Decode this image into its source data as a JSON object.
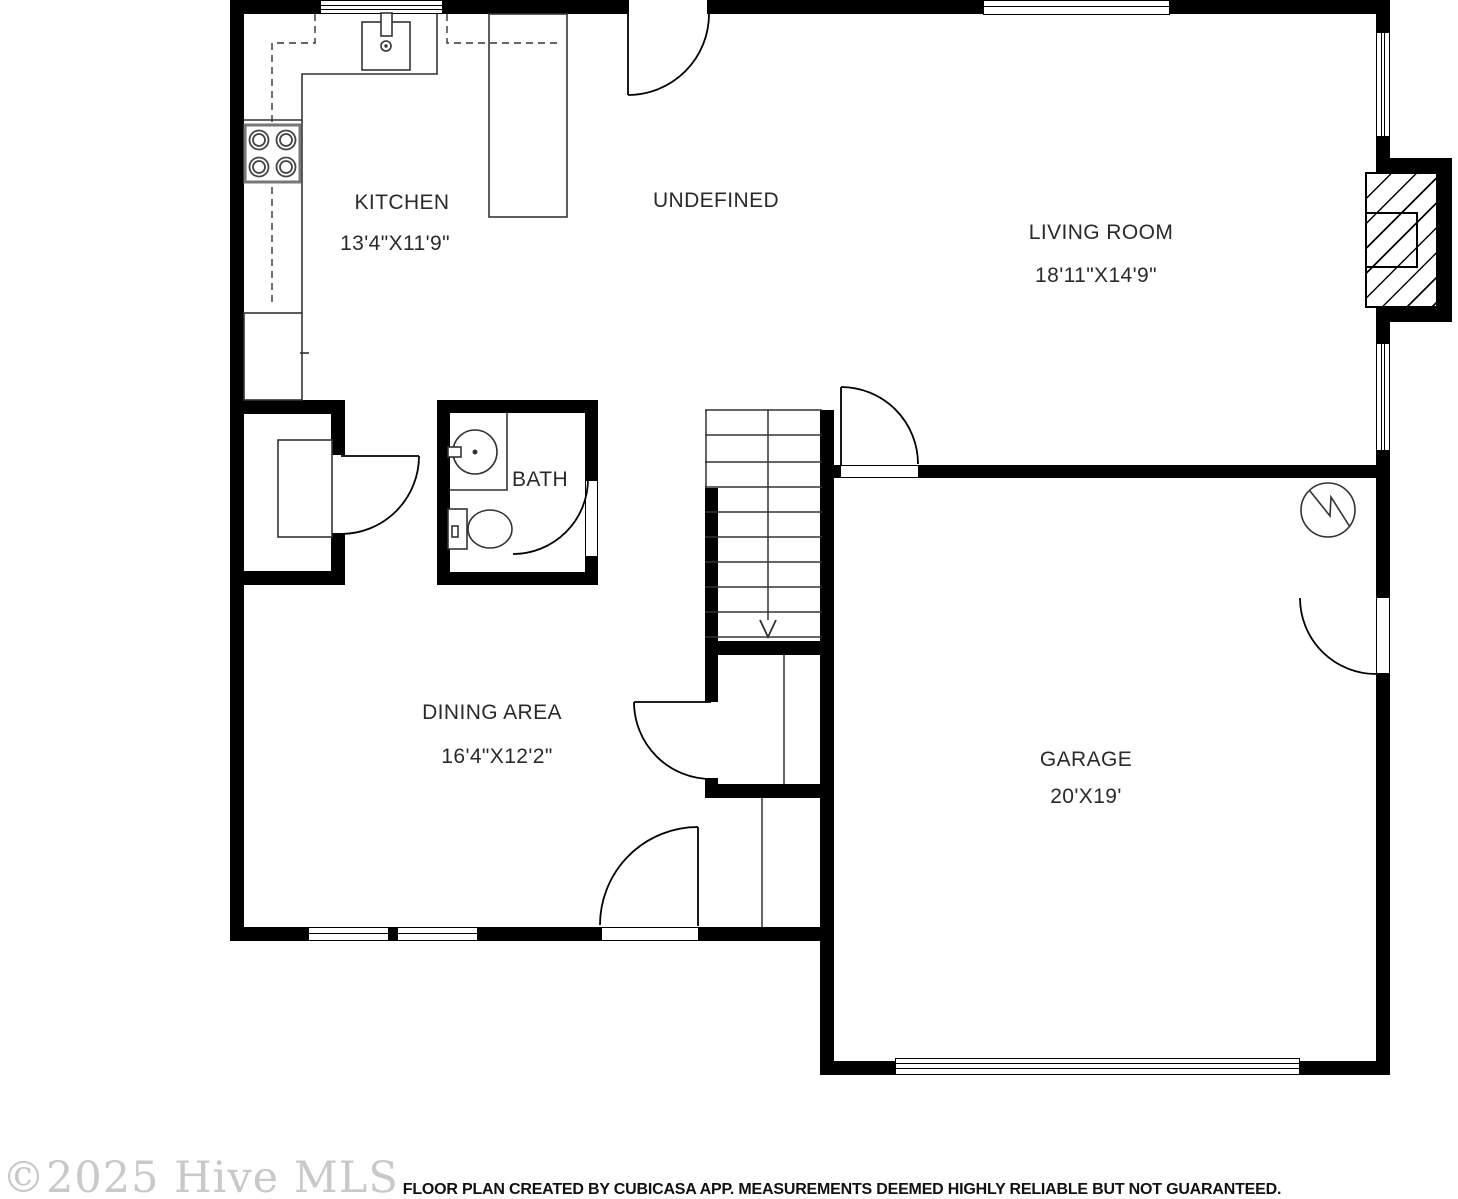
{
  "colors": {
    "wall": "#000000",
    "fixture_line": "#333333",
    "label_text": "#2a2a2a",
    "watermark_text": "#c9c9c9",
    "footer_text": "#111111",
    "background": "#ffffff"
  },
  "rooms": [
    {
      "key": "kitchen",
      "label": "KITCHEN",
      "dims": "13'4\"X11'9\""
    },
    {
      "key": "undefined",
      "label": "UNDEFINED",
      "dims": ""
    },
    {
      "key": "living_room",
      "label": "LIVING ROOM",
      "dims": "18'11\"X14'9\""
    },
    {
      "key": "bath",
      "label": "BATH",
      "dims": ""
    },
    {
      "key": "dining_area",
      "label": "DINING AREA",
      "dims": "16'4\"X12'2\""
    },
    {
      "key": "garage",
      "label": "GARAGE",
      "dims": "20'X19'"
    }
  ],
  "icons": {
    "stove-icon": "four-burner cooktop",
    "kitchen-sink-icon": "kitchen sink with faucet",
    "refrigerator-icon": "refrigerator",
    "bathroom-sink-icon": "round basin with faucet",
    "toilet-icon": "toilet with tank",
    "fireplace-icon": "hatched fireplace box",
    "electrical-meter-icon": "circle with zigzag bolt",
    "stairs-icon": "staircase with down arrow",
    "door-icon": "door swing arc",
    "window-icon": "window in wall"
  },
  "watermark": "©2025 Hive MLS",
  "footer": "FLOOR PLAN CREATED BY CUBICASA APP. MEASUREMENTS DEEMED HIGHLY RELIABLE BUT NOT GUARANTEED."
}
